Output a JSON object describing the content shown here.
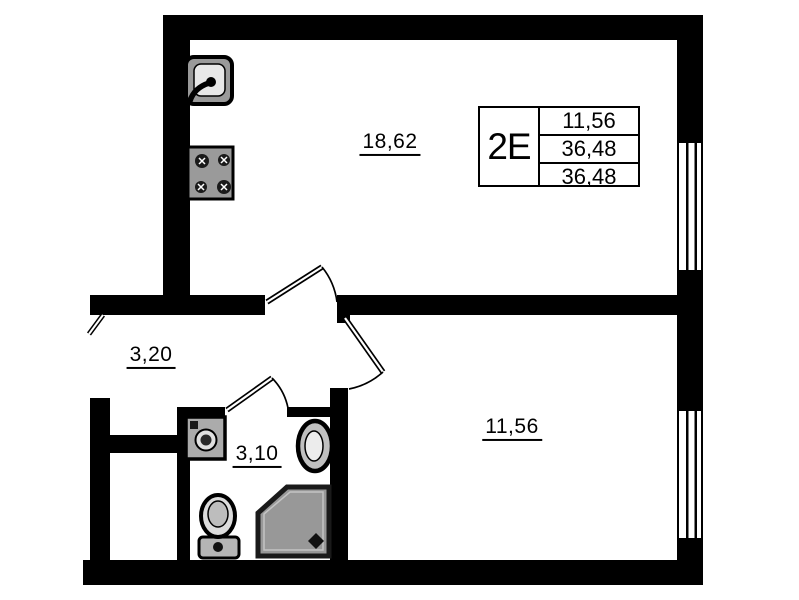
{
  "unit_card": {
    "unit_type": "2E",
    "values": [
      "11,56",
      "36,48",
      "36,48"
    ]
  },
  "rooms": {
    "living_kitchen_area": "18,62",
    "hallway_area": "3,20",
    "bathroom_area": "3,10",
    "room_area": "11,56"
  },
  "fixtures": [
    "kitchen-sink",
    "stove",
    "washing-machine",
    "wash-basin",
    "toilet",
    "shower"
  ],
  "colors": {
    "wall": "#000000",
    "background": "#ffffff",
    "fixture_gray": "#9a9a9a",
    "shower_gray": "#989898"
  }
}
